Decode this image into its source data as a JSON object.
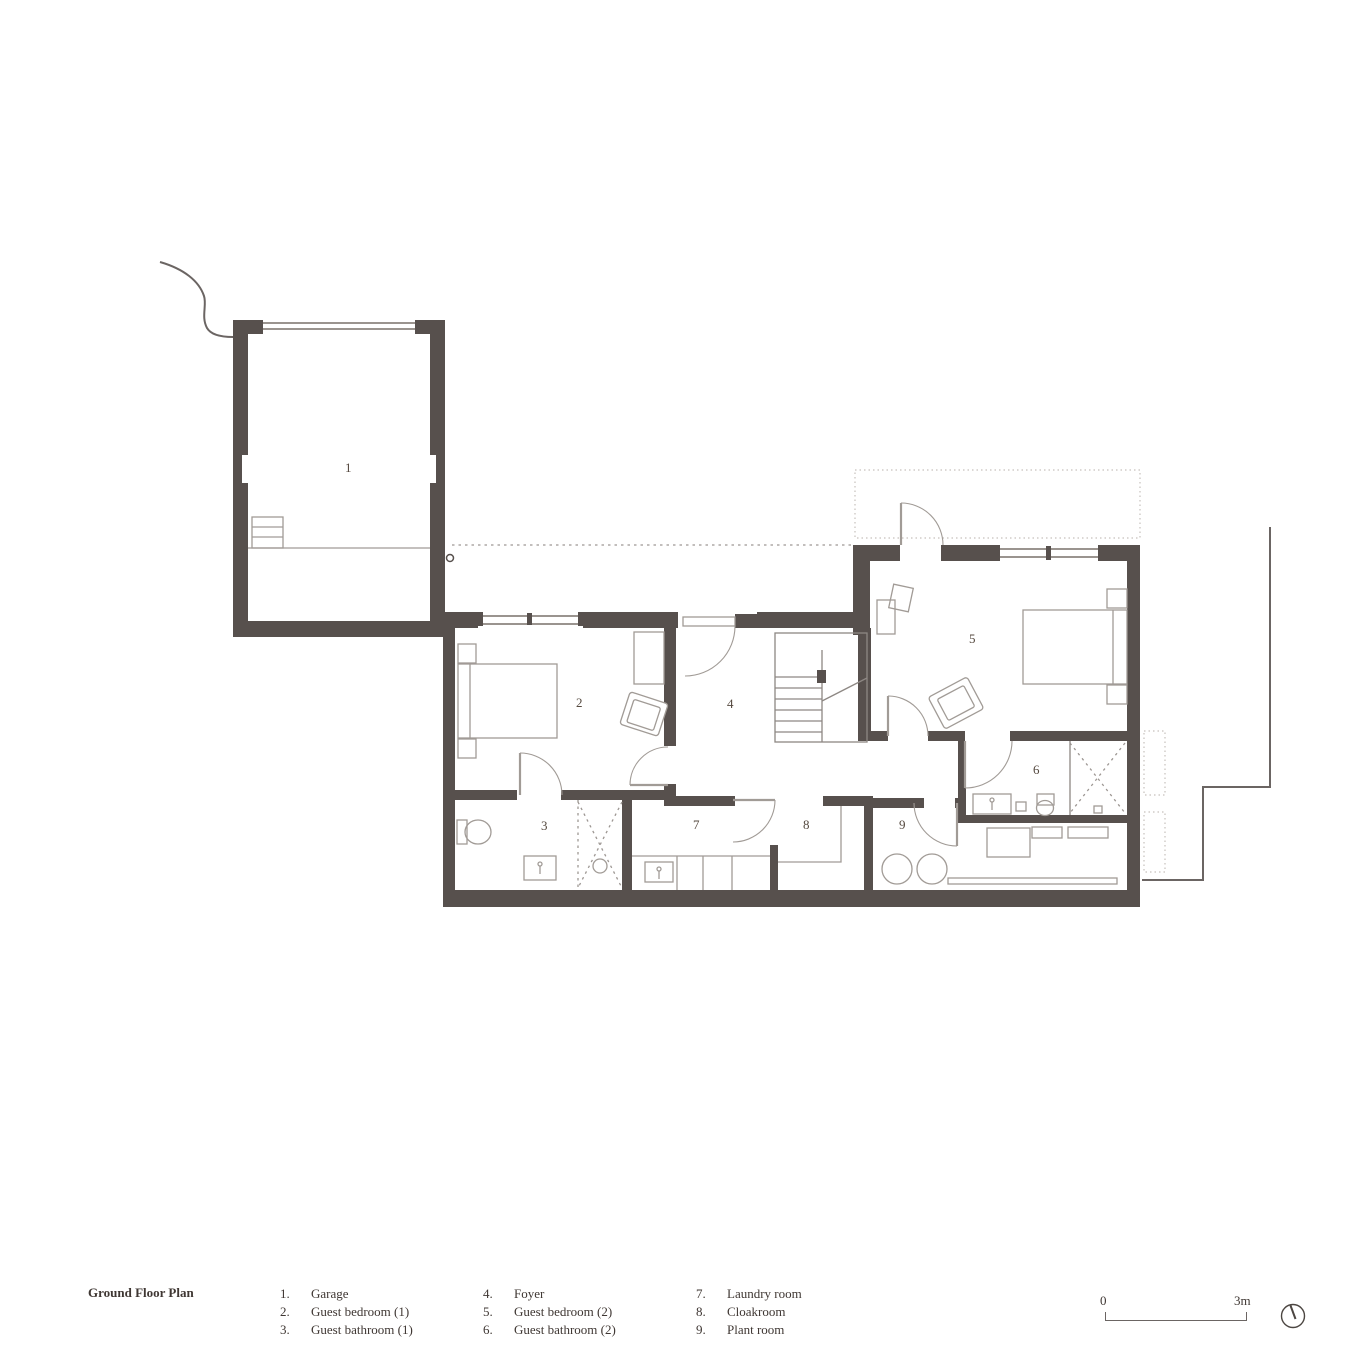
{
  "title": "Ground Floor Plan",
  "plan": {
    "rooms": [
      {
        "number": "1",
        "room": "Garage"
      },
      {
        "number": "2",
        "room": "Guest bedroom (1)"
      },
      {
        "number": "3",
        "room": "Guest bathroom (1)"
      },
      {
        "number": "4",
        "room": "Foyer"
      },
      {
        "number": "5",
        "room": "Guest bedroom (2)"
      },
      {
        "number": "6",
        "room": "Guest bathroom (2)"
      },
      {
        "number": "7",
        "room": "Laundry room"
      },
      {
        "number": "8",
        "room": "Cloakroom"
      },
      {
        "number": "9",
        "room": "Plant room"
      }
    ],
    "icons": {
      "north_arrow": "circle-with-needle"
    },
    "scale_bar": {
      "start": "0",
      "end": "3m"
    }
  },
  "legend": {
    "columns": [
      {
        "items": [
          {
            "num": "1.",
            "label": "Garage"
          },
          {
            "num": "2.",
            "label": "Guest bedroom (1)"
          },
          {
            "num": "3.",
            "label": "Guest bathroom (1)"
          }
        ]
      },
      {
        "items": [
          {
            "num": "4.",
            "label": "Foyer"
          },
          {
            "num": "5.",
            "label": "Guest bedroom (2)"
          },
          {
            "num": "6.",
            "label": "Guest bathroom (2)"
          }
        ]
      },
      {
        "items": [
          {
            "num": "7.",
            "label": "Laundry room"
          },
          {
            "num": "8.",
            "label": "Cloakroom"
          },
          {
            "num": "9.",
            "label": "Plant room"
          }
        ]
      }
    ]
  },
  "colors": {
    "wall": "#57504d",
    "thin": "#8d8783",
    "furn": "#a19b96",
    "win": "#9a948f",
    "dash": "#9d9793",
    "dot": "#c6c0bc",
    "bound": "#6b6563",
    "number": "#55493f",
    "text": "#3f3733"
  }
}
